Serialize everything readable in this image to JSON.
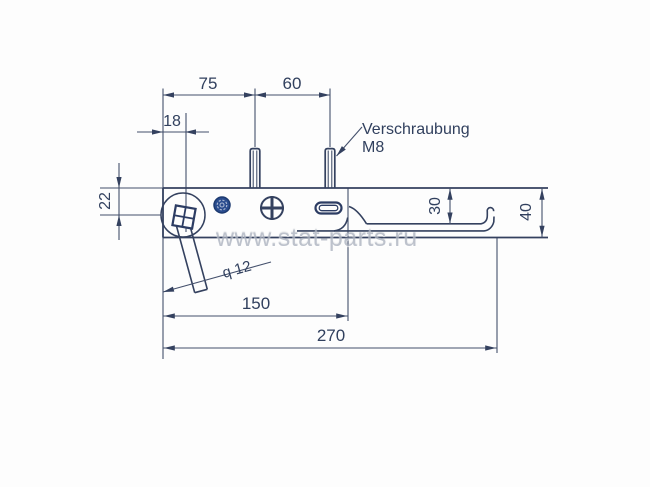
{
  "drawing": {
    "watermark": "www.stat-parts.ru",
    "annotation": {
      "line1": "Verschraubung",
      "line2": "M8"
    },
    "dimensions": {
      "top_left": "75",
      "top_right": "60",
      "hole_offset": "18",
      "vertical_offset": "22",
      "hook_depth": "30",
      "total_height": "40",
      "stem_diameter": "q 12",
      "mid_length": "150",
      "total_length": "270"
    },
    "colors": {
      "line": "#34415f",
      "knob_fill": "#2a4c8e",
      "watermark_gray": "#aeb4c1"
    }
  }
}
